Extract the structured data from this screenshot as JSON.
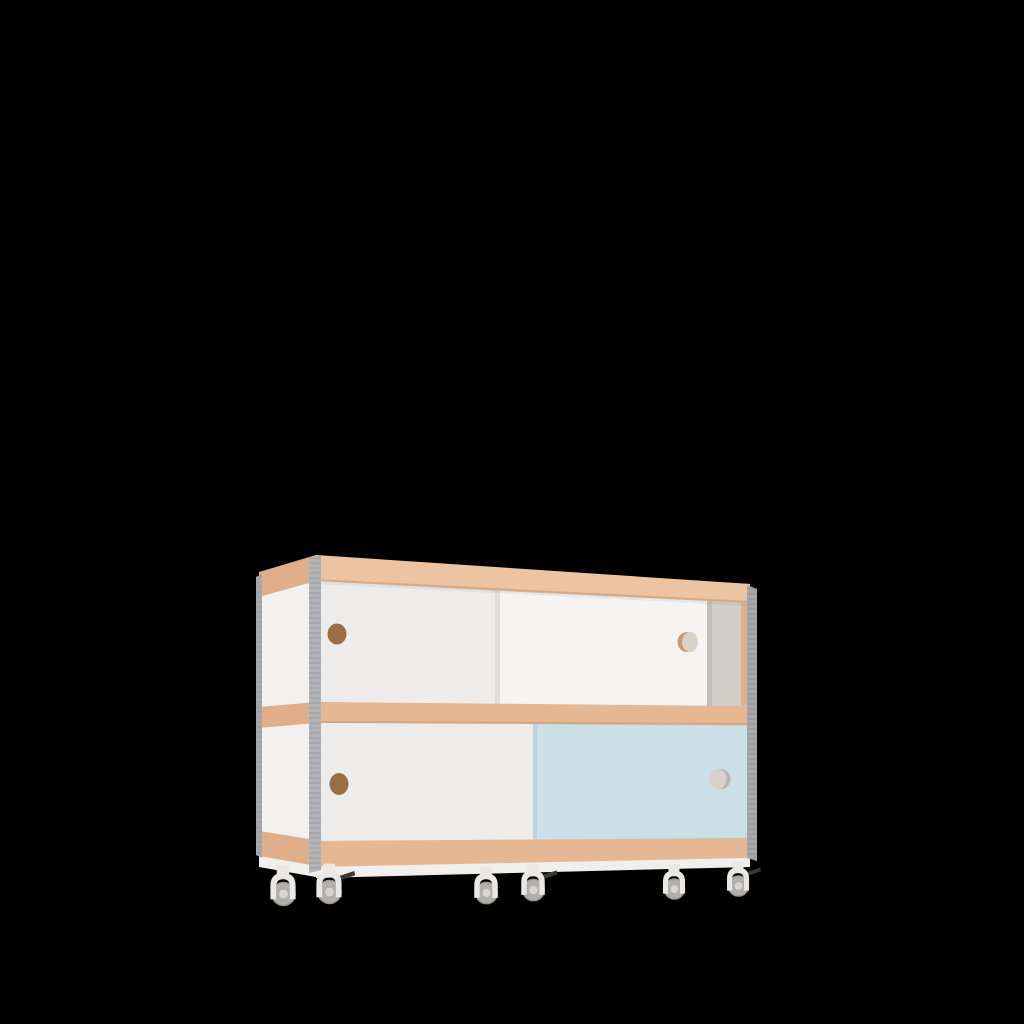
{
  "scene": {
    "subject": "two-tier sideboard cabinet with sliding doors on casters",
    "background": "#000000",
    "cabinet": {
      "rows": 2,
      "doors": [
        {
          "row": "top",
          "position": "left",
          "color_name": "white",
          "handle": "finger-hole"
        },
        {
          "row": "top",
          "position": "right",
          "color_name": "white",
          "handle": "finger-hole"
        },
        {
          "row": "bottom",
          "position": "left",
          "color_name": "white",
          "handle": "finger-hole"
        },
        {
          "row": "bottom",
          "position": "right",
          "color_name": "light-blue",
          "handle": "finger-hole"
        }
      ],
      "finger_holes": 4,
      "open_gap": "top-right interior visible behind doors",
      "casters": {
        "count": 6,
        "with_brake_lever": 3
      }
    },
    "colors": {
      "background": "#000000",
      "wood_top": "#ecc4a2",
      "wood_front": "#e5b793",
      "wood_side": "#e0ae88",
      "wood_edge_shadow": "#c79469",
      "inner_wood_sliver": "#dcb28c",
      "door_white_back": "#eeecea",
      "door_white_front": "#f5f4f2",
      "door_blue": "#cbdfe9",
      "side_panel": "#f3f1ef",
      "interior": "#d2cec9",
      "edge_gray": "#a6a7ab",
      "edge_gray_light": "#b3b4b8",
      "edge_stripe": "#8c8d91",
      "hole_brown": "#9c6f42",
      "hole_light": "#d7d1c9",
      "hole_rim_tan": "#c69873",
      "plinth_white": "#f0efec",
      "caster_body": "#eae8e4",
      "wheel_gray": "#b1aeab",
      "wheel_rim": "#989593",
      "wheel_hub": "#d8d5d1",
      "brake_dark": "#3a3a3b"
    }
  }
}
